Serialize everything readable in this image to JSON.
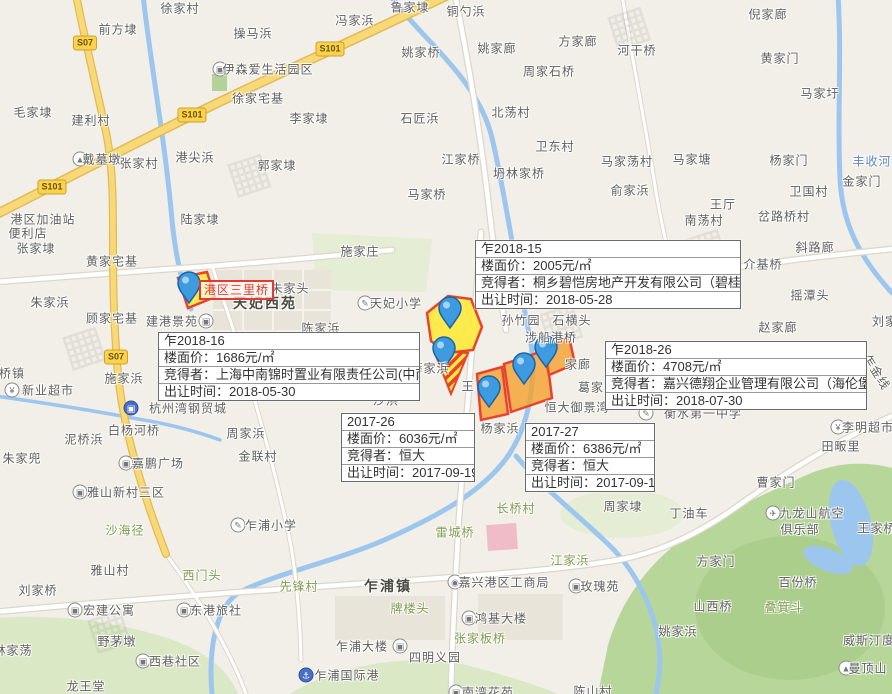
{
  "map": {
    "canvas": {
      "width": 892,
      "height": 694
    },
    "colors": {
      "land": "#f2efe8",
      "water": "#9dc6ee",
      "green_hill": "#b7d69a",
      "road_yellow": "#f8d979",
      "road_white": "#ffffff",
      "parcel_yellow": "#ffe93e",
      "parcel_orange": "#f5a02d",
      "parcel_border": "#e8432e",
      "pin_fill": "#3f9be0",
      "pin_border": "#1a65a8",
      "label": "#5f5f5f",
      "label_green": "#7f9b50",
      "label_water": "#5a87c5",
      "info_box_border": "#6a6a6a",
      "info_box_text": "#333333",
      "red_label": "#e03c31"
    },
    "icon_glyphs": {
      "building": "▣",
      "school": "✎",
      "monument": "▲",
      "shop": "¥",
      "gov": "◉",
      "plane": "✈",
      "mountain": "▲",
      "anchor": "⚓",
      "hotel": "▣",
      "steel": "▣"
    },
    "watermark_glyph": "▦",
    "road_badges": [
      {
        "text": "S07",
        "x": 85,
        "y": 43
      },
      {
        "text": "S101",
        "x": 330,
        "y": 49
      },
      {
        "text": "S101",
        "x": 192,
        "y": 115
      },
      {
        "text": "S101",
        "x": 52,
        "y": 187
      },
      {
        "text": "S07",
        "x": 116,
        "y": 357
      }
    ],
    "area_label": {
      "text": "港区三里桥",
      "x": 199,
      "y": 280
    },
    "field_labels": {
      "price": "楼面价：",
      "winner": "竞得者：",
      "date": "出让时间："
    },
    "info_boxes": [
      {
        "plot_id": "乍2018-15",
        "floor_price": "2005元/㎡",
        "winner": "桐乡碧恺房地产开发有限公司（碧桂园）",
        "sale_date": "2018-05-28",
        "x": 475,
        "y": 240,
        "w": 264
      },
      {
        "plot_id": "乍2018-16",
        "floor_price": "1686元/㎡",
        "winner": "上海中南锦时置业有限责任公司(中南）",
        "sale_date": "2018-05-30",
        "x": 158,
        "y": 332,
        "w": 260
      },
      {
        "plot_id": "乍2018-26",
        "floor_price": "4708元/㎡",
        "winner": "嘉兴德翔企业管理有限公司（海伦堡）",
        "sale_date": "2018-07-30",
        "x": 605,
        "y": 341,
        "w": 260
      },
      {
        "plot_id": "2017-26",
        "floor_price": "6036元/㎡",
        "winner": "恒大",
        "sale_date": "2017-09-19",
        "x": 341,
        "y": 413,
        "w": 132
      },
      {
        "plot_id": "2017-27",
        "floor_price": "6386元/㎡",
        "winner": "恒大",
        "sale_date": "2017-09-19",
        "x": 525,
        "y": 423,
        "w": 128
      }
    ],
    "parcels": [
      {
        "type": "yellow",
        "points": "178,278 207,272 215,297 188,308"
      },
      {
        "type": "yellow",
        "points": "427,313 448,296 471,299 482,327 473,350 447,353 431,341"
      },
      {
        "type": "striped",
        "points": "434,351 468,353 451,394"
      },
      {
        "type": "orange",
        "points": "477,374 502,367 508,414 481,420"
      },
      {
        "type": "orange",
        "points": "504,364 546,350 552,398 511,412"
      },
      {
        "type": "orange",
        "points": "543,346 569,337 575,364 549,375"
      }
    ],
    "pins": [
      {
        "x": 189,
        "y": 303
      },
      {
        "x": 450,
        "y": 328
      },
      {
        "x": 444,
        "y": 368
      },
      {
        "x": 489,
        "y": 407
      },
      {
        "x": 524,
        "y": 384
      },
      {
        "x": 546,
        "y": 367
      }
    ],
    "watermarks": [
      {
        "x": 248,
        "y": 172
      },
      {
        "x": 705,
        "y": 247
      },
      {
        "x": 83,
        "y": 345
      },
      {
        "x": 560,
        "y": 322
      },
      {
        "x": 108,
        "y": 628
      },
      {
        "x": 628,
        "y": 25
      }
    ],
    "labels": [
      {
        "text": "徐家村",
        "x": 180,
        "y": 8
      },
      {
        "text": "前方埭",
        "x": 118,
        "y": 29
      },
      {
        "text": "操马浜",
        "x": 253,
        "y": 33
      },
      {
        "text": "冯家浜",
        "x": 355,
        "y": 20
      },
      {
        "text": "鲁家埭",
        "x": 410,
        "y": 7
      },
      {
        "text": "铜勺浜",
        "x": 466,
        "y": 11
      },
      {
        "text": "姚家桥",
        "x": 421,
        "y": 52
      },
      {
        "text": "姚家廊",
        "x": 497,
        "y": 48
      },
      {
        "text": "方家廊",
        "x": 578,
        "y": 41
      },
      {
        "text": "周家石桥",
        "x": 549,
        "y": 71
      },
      {
        "text": "倪家廊",
        "x": 768,
        "y": 14
      },
      {
        "text": "河干桥",
        "x": 637,
        "y": 50
      },
      {
        "text": "黄家门",
        "x": 780,
        "y": 58
      },
      {
        "text": "马家圩",
        "x": 820,
        "y": 93
      },
      {
        "text": "伊森爱生活园区",
        "x": 268,
        "y": 69,
        "icon": "building",
        "icon_x": 220
      },
      {
        "text": "毛家埭",
        "x": 33,
        "y": 112
      },
      {
        "text": "建利村",
        "x": 91,
        "y": 120
      },
      {
        "text": "徐家宅基",
        "x": 258,
        "y": 98
      },
      {
        "text": "李家埭",
        "x": 309,
        "y": 118
      },
      {
        "text": "石匠浜",
        "x": 420,
        "y": 118
      },
      {
        "text": "北荡村",
        "x": 511,
        "y": 112
      },
      {
        "text": "卫东村",
        "x": 555,
        "y": 146
      },
      {
        "text": "江家桥",
        "x": 461,
        "y": 159
      },
      {
        "text": "坍林家桥",
        "x": 519,
        "y": 173
      },
      {
        "text": "马家桥",
        "x": 427,
        "y": 194
      },
      {
        "text": "马家荡村",
        "x": 627,
        "y": 161
      },
      {
        "text": "马家塘",
        "x": 692,
        "y": 159
      },
      {
        "text": "杨家门",
        "x": 789,
        "y": 160
      },
      {
        "text": "丰收河",
        "x": 872,
        "y": 161,
        "type": "water"
      },
      {
        "text": "俞家浜",
        "x": 630,
        "y": 190
      },
      {
        "text": "金家门",
        "x": 862,
        "y": 181
      },
      {
        "text": "卫国村",
        "x": 809,
        "y": 191
      },
      {
        "text": "王厅",
        "x": 723,
        "y": 204
      },
      {
        "text": "南荡村",
        "x": 704,
        "y": 220
      },
      {
        "text": "岔路桥村",
        "x": 784,
        "y": 216
      },
      {
        "text": "戴墓墩",
        "x": 102,
        "y": 159,
        "icon": "monument",
        "icon_x": 80
      },
      {
        "text": "张家村",
        "x": 139,
        "y": 163
      },
      {
        "text": "港尖浜",
        "x": 195,
        "y": 157
      },
      {
        "text": "郭家埭",
        "x": 277,
        "y": 165
      },
      {
        "text": "陆家埭",
        "x": 200,
        "y": 219
      },
      {
        "text": "港区加油站",
        "x": 43,
        "y": 219
      },
      {
        "text": "便利店",
        "x": 28,
        "y": 233
      },
      {
        "text": "张家埭",
        "x": 36,
        "y": 248
      },
      {
        "text": "黄家宅基",
        "x": 112,
        "y": 261
      },
      {
        "text": "朱家浜",
        "x": 50,
        "y": 302
      },
      {
        "text": "顾家宅基",
        "x": 112,
        "y": 318
      },
      {
        "text": "建港景苑",
        "x": 172,
        "y": 321,
        "icon": "building",
        "icon_x": 206
      },
      {
        "text": "桥镇",
        "x": 12,
        "y": 373
      },
      {
        "text": "新业超市",
        "x": 48,
        "y": 390,
        "icon": "shop",
        "icon_x": 12
      },
      {
        "text": "施家浜",
        "x": 124,
        "y": 378
      },
      {
        "text": "施家庄",
        "x": 360,
        "y": 251
      },
      {
        "text": "朱家头",
        "x": 290,
        "y": 288
      },
      {
        "text": "天妃西苑",
        "x": 265,
        "y": 303,
        "type": "town"
      },
      {
        "text": "天妃小学",
        "x": 396,
        "y": 303,
        "icon": "school",
        "icon_x": 365
      },
      {
        "text": "陈家浜",
        "x": 321,
        "y": 328
      },
      {
        "text": "薛家浜",
        "x": 430,
        "y": 368
      },
      {
        "text": "沙浜",
        "x": 386,
        "y": 400
      },
      {
        "text": "王",
        "x": 468,
        "y": 386
      },
      {
        "text": "杭州湾钢贸城",
        "x": 188,
        "y": 408,
        "icon": "steel",
        "icon_x": 131,
        "icon_filled": true
      },
      {
        "text": "白杨河桥",
        "x": 134,
        "y": 430
      },
      {
        "text": "泥桥浜",
        "x": 84,
        "y": 439
      },
      {
        "text": "周家浜",
        "x": 246,
        "y": 433
      },
      {
        "text": "金联村",
        "x": 258,
        "y": 456
      },
      {
        "text": "嘉鹏广场",
        "x": 158,
        "y": 463,
        "icon": "building",
        "icon_x": 126
      },
      {
        "text": "朱家兜",
        "x": 22,
        "y": 458
      },
      {
        "text": "雅山新村三区",
        "x": 126,
        "y": 492,
        "icon": "building",
        "icon_x": 80
      },
      {
        "text": "沙海径",
        "x": 125,
        "y": 530,
        "type": "green"
      },
      {
        "text": "雅山村",
        "x": 110,
        "y": 570
      },
      {
        "text": "西门头",
        "x": 202,
        "y": 575,
        "type": "green"
      },
      {
        "text": "乍浦小学",
        "x": 271,
        "y": 525,
        "icon": "school",
        "icon_x": 238
      },
      {
        "text": "先锋村",
        "x": 299,
        "y": 586,
        "type": "green"
      },
      {
        "text": "刘家桥",
        "x": 38,
        "y": 590
      },
      {
        "text": "宏建公寓",
        "x": 109,
        "y": 610,
        "icon": "building",
        "icon_x": 75
      },
      {
        "text": "东港旅社",
        "x": 216,
        "y": 610,
        "icon": "hotel",
        "icon_x": 184
      },
      {
        "text": "野茅墩",
        "x": 117,
        "y": 641
      },
      {
        "text": "林家荡",
        "x": 13,
        "y": 650
      },
      {
        "text": "西巷社区",
        "x": 175,
        "y": 661,
        "icon": "building",
        "icon_x": 143
      },
      {
        "text": "龙王堂",
        "x": 86,
        "y": 686
      },
      {
        "text": "乍浦大楼",
        "x": 362,
        "y": 646,
        "icon": "building",
        "icon_x": 400
      },
      {
        "text": "乍浦国际港",
        "x": 347,
        "y": 675,
        "icon": "anchor",
        "icon_x": 306,
        "icon_filled": true
      },
      {
        "text": "四明义园",
        "x": 435,
        "y": 657
      },
      {
        "text": "南湾花苑",
        "x": 488,
        "y": 692,
        "icon": "building",
        "icon_x": 456
      },
      {
        "text": "乍浦镇",
        "x": 388,
        "y": 586,
        "type": "town"
      },
      {
        "text": "牌楼头",
        "x": 410,
        "y": 608,
        "type": "green"
      },
      {
        "text": "嘉兴港区工商局",
        "x": 504,
        "y": 582,
        "icon": "gov",
        "icon_x": 455
      },
      {
        "text": "鸿基大楼",
        "x": 501,
        "y": 618,
        "icon": "building",
        "icon_x": 469
      },
      {
        "text": "张家板桥",
        "x": 480,
        "y": 638,
        "type": "green"
      },
      {
        "text": "雷城桥",
        "x": 455,
        "y": 532,
        "type": "green"
      },
      {
        "text": "长桥村",
        "x": 516,
        "y": 508,
        "type": "green"
      },
      {
        "text": "江家浜",
        "x": 570,
        "y": 560,
        "type": "green"
      },
      {
        "text": "玫瑰苑",
        "x": 600,
        "y": 586,
        "icon": "building",
        "icon_x": 576
      },
      {
        "text": "周家埭",
        "x": 623,
        "y": 506
      },
      {
        "text": "丁油车",
        "x": 689,
        "y": 513
      },
      {
        "text": "曹家门",
        "x": 776,
        "y": 482
      },
      {
        "text": "九龙山航空",
        "x": 812,
        "y": 513,
        "icon": "plane",
        "icon_x": 773
      },
      {
        "text": "俱乐部",
        "x": 800,
        "y": 529
      },
      {
        "text": "王家桥",
        "x": 877,
        "y": 528
      },
      {
        "text": "方家门",
        "x": 716,
        "y": 561
      },
      {
        "text": "百份桥",
        "x": 798,
        "y": 582
      },
      {
        "text": "山西桥",
        "x": 713,
        "y": 606
      },
      {
        "text": "叠箕斗",
        "x": 784,
        "y": 607,
        "type": "green"
      },
      {
        "text": "姚家浜",
        "x": 678,
        "y": 631
      },
      {
        "text": "威斯汀度",
        "x": 869,
        "y": 640
      },
      {
        "text": "曼顶山",
        "x": 868,
        "y": 668,
        "icon": "mountain",
        "icon_x": 846
      },
      {
        "text": "陈山村",
        "x": 593,
        "y": 691
      },
      {
        "text": "孙竹园",
        "x": 521,
        "y": 320
      },
      {
        "text": "石横头",
        "x": 572,
        "y": 320
      },
      {
        "text": "涉船港桥",
        "x": 551,
        "y": 337
      },
      {
        "text": "家廊",
        "x": 578,
        "y": 364
      },
      {
        "text": "葛家",
        "x": 591,
        "y": 387
      },
      {
        "text": "恒大御景湾",
        "x": 577,
        "y": 407
      },
      {
        "text": "衡水第一中学",
        "x": 703,
        "y": 413,
        "icon": "school",
        "icon_x": 646
      },
      {
        "text": "杨家浜",
        "x": 500,
        "y": 428
      },
      {
        "text": "李明超市",
        "x": 868,
        "y": 427,
        "icon": "shop",
        "icon_x": 838
      },
      {
        "text": "田畈里",
        "x": 841,
        "y": 446
      },
      {
        "text": "斜路廊",
        "x": 815,
        "y": 247
      },
      {
        "text": "介基桥",
        "x": 763,
        "y": 264
      },
      {
        "text": "摇潭头",
        "x": 810,
        "y": 295
      },
      {
        "text": "赵家廊",
        "x": 778,
        "y": 327
      },
      {
        "text": "刘家",
        "x": 885,
        "y": 321
      },
      {
        "text": "乍金线",
        "x": 877,
        "y": 372,
        "rotate": 58
      }
    ]
  }
}
